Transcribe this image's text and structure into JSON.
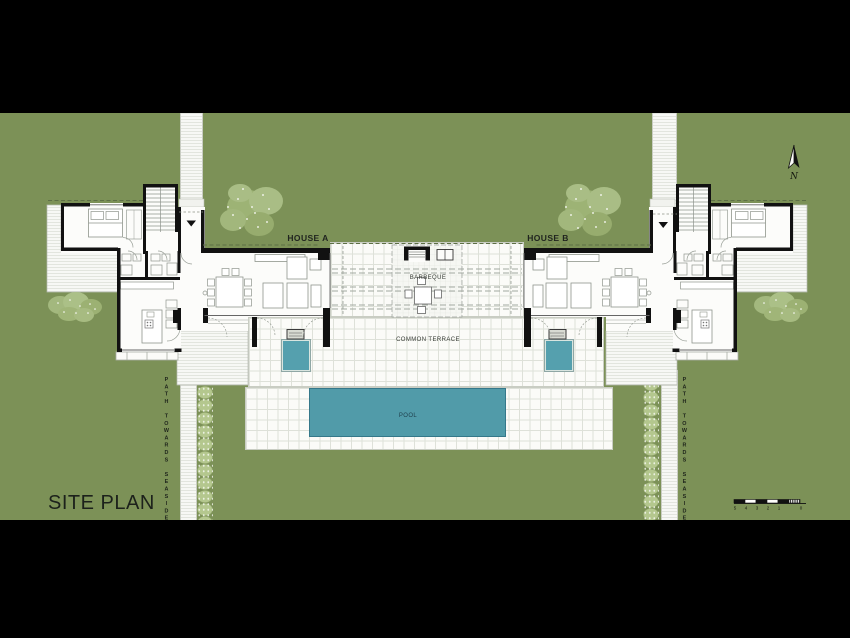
{
  "title": {
    "label": "SITE PLAN"
  },
  "plan": {
    "house_a_label": "HOUSE A",
    "house_b_label": "HOUSE B",
    "barbeque_label": "BARBEQUE",
    "common_terrace_label": "COMMON TERRACE",
    "pool_label": "POOL",
    "path_towards_seaside_label": "PATH TOWARDS SEASIDE"
  },
  "north": {
    "label": "N"
  },
  "scalebar": {
    "labels": [
      "5",
      "4",
      "3",
      "2",
      "1",
      "0"
    ]
  },
  "colors": {
    "background": "#000000",
    "grass": "#7c9157",
    "tree_canopy": "#9db375",
    "hedge": "#b4c78e",
    "pool": "#519ba9",
    "spa": "#55a0ae",
    "wall": "#111111",
    "tile": "#fbfbf8",
    "tile_line": "#dee1d9"
  }
}
